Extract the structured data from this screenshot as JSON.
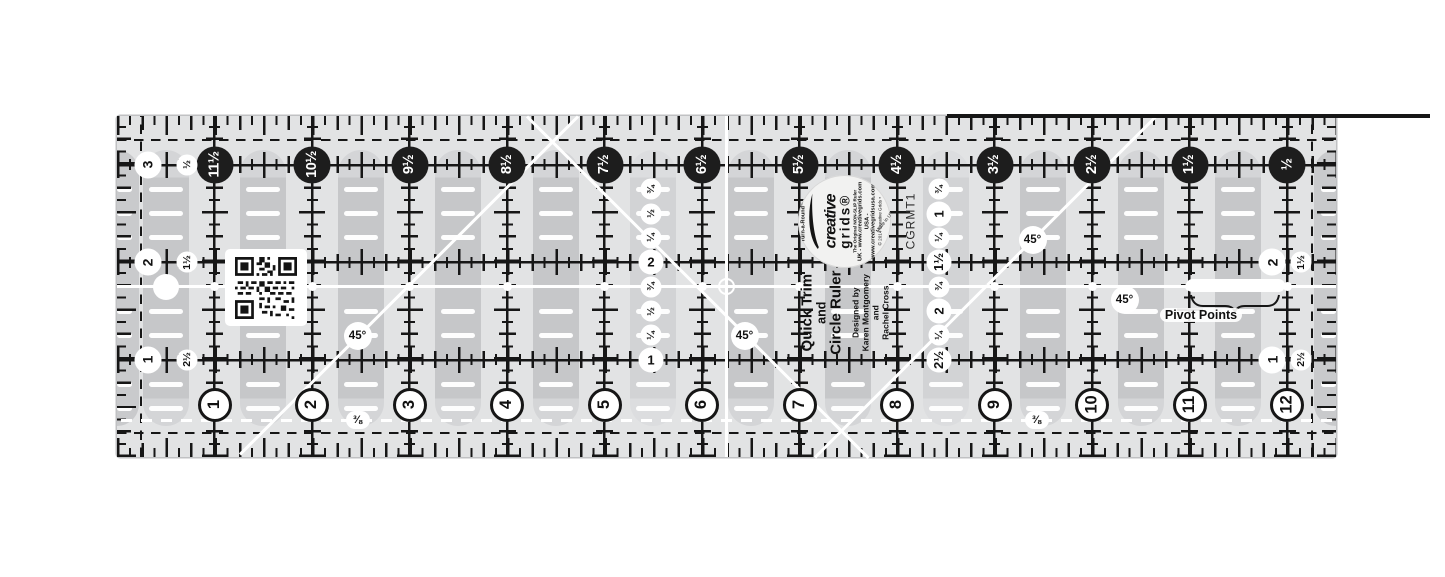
{
  "ruler": {
    "top_scale": [
      "11½",
      "10½",
      "9½",
      "8½",
      "7½",
      "6½",
      "5½",
      "4½",
      "3½",
      "2½",
      "1½",
      "½"
    ],
    "bottom_scale": [
      "1",
      "2",
      "3",
      "4",
      "5",
      "6",
      "7",
      "8",
      "9",
      "10",
      "11",
      "12"
    ],
    "left_edge_pairs": [
      {
        "inch": "3",
        "complement": "½"
      },
      {
        "inch": "2",
        "complement": "1½"
      },
      {
        "inch": "1",
        "complement": "2½"
      }
    ],
    "right_edge_pairs": [
      {
        "inch": "2",
        "complement": "1½"
      },
      {
        "inch": "1",
        "complement": "2½"
      }
    ],
    "left_fraction_column": [
      "¾",
      "½",
      "¼",
      "2",
      "¾",
      "½",
      "¼",
      "1"
    ],
    "right_fraction_column": [
      "¾",
      "1",
      "¼",
      "1½",
      "¾",
      "2",
      "¼",
      "2½"
    ],
    "angle_labels": [
      "45°",
      "45°",
      "45°",
      "45°"
    ],
    "grid_fraction_labels": [
      "⅜",
      "⅜"
    ],
    "pivot": {
      "label": "Pivot Points"
    },
    "logo": {
      "pre": "Turn-a-Round™",
      "brand": "creative",
      "brand2": "grids®",
      "tagline": "The Original NON-SLIP Ruler",
      "uk": "UK - www.creativegrids.com",
      "usa": "USA - www.creativegridsusa.com",
      "copyright": "© 2014 Creative Grids •",
      "made_in": "Made in USA"
    },
    "product": {
      "title1": "Quick Trim",
      "title2": "and",
      "title3": "Circle Ruler",
      "designer1": "Designed by",
      "designer2": "Karen Montgomery",
      "designer3": "and",
      "designer4": "Rachel Cross",
      "sku": "CGRMT1"
    },
    "colors": {
      "ruler_body": "#e2e3e4",
      "grip_bar": "#c6c7c9",
      "ink": "#161616",
      "marking_white": "#ffffff",
      "scale_circle": "#1d1d1d"
    }
  }
}
